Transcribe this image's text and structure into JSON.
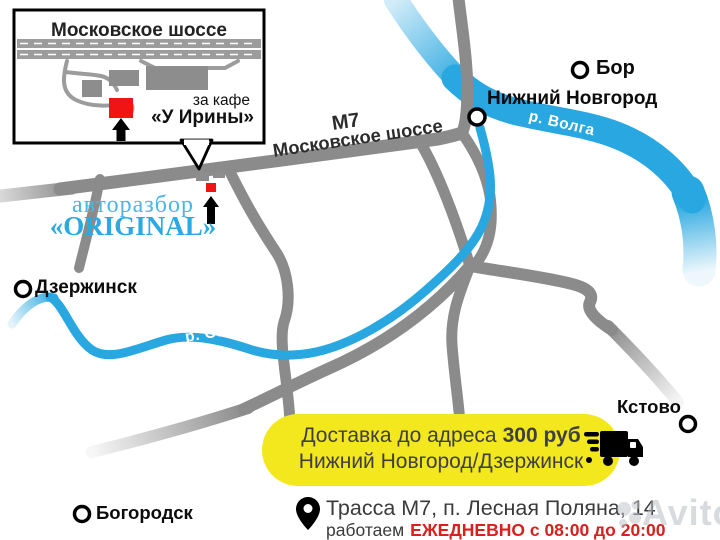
{
  "inset": {
    "title": "Московское шоссе",
    "note_small": "за кафе",
    "note_big": "«У Ирины»"
  },
  "highway": {
    "code": "М7",
    "name": "Московское шоссе"
  },
  "business": {
    "type": "авторазбор",
    "name": "«ORIGINAL»"
  },
  "cities": {
    "dzerzhinsk": "Дзержинск",
    "nizhny": "Нижний Новгород",
    "bor": "Бор",
    "kstovo": "Кстово",
    "bogorodsk": "Богородск"
  },
  "rivers": {
    "oka": "р. Ока",
    "volga": "р. Волга"
  },
  "delivery": {
    "line1_text": "Доставка до адреса",
    "line1_price": "300 руб",
    "line2": "Нижний Новгород/Дзержинск"
  },
  "address": {
    "line1": "Трасса М7, п. Лесная Поляна, 14",
    "line2_prefix": "работаем",
    "line2_schedule": "ЕЖЕДНЕВНО с 08:00 до 20:00"
  },
  "watermark": {
    "text": "Avito"
  },
  "colors": {
    "river_blue": "#29a7e0",
    "road_gray": "#8b8b8b",
    "banner_yellow": "#f3e71e",
    "alert_red": "#d8211f",
    "brand_blue": "#2ba9e0",
    "poi_red": "#f11414"
  }
}
